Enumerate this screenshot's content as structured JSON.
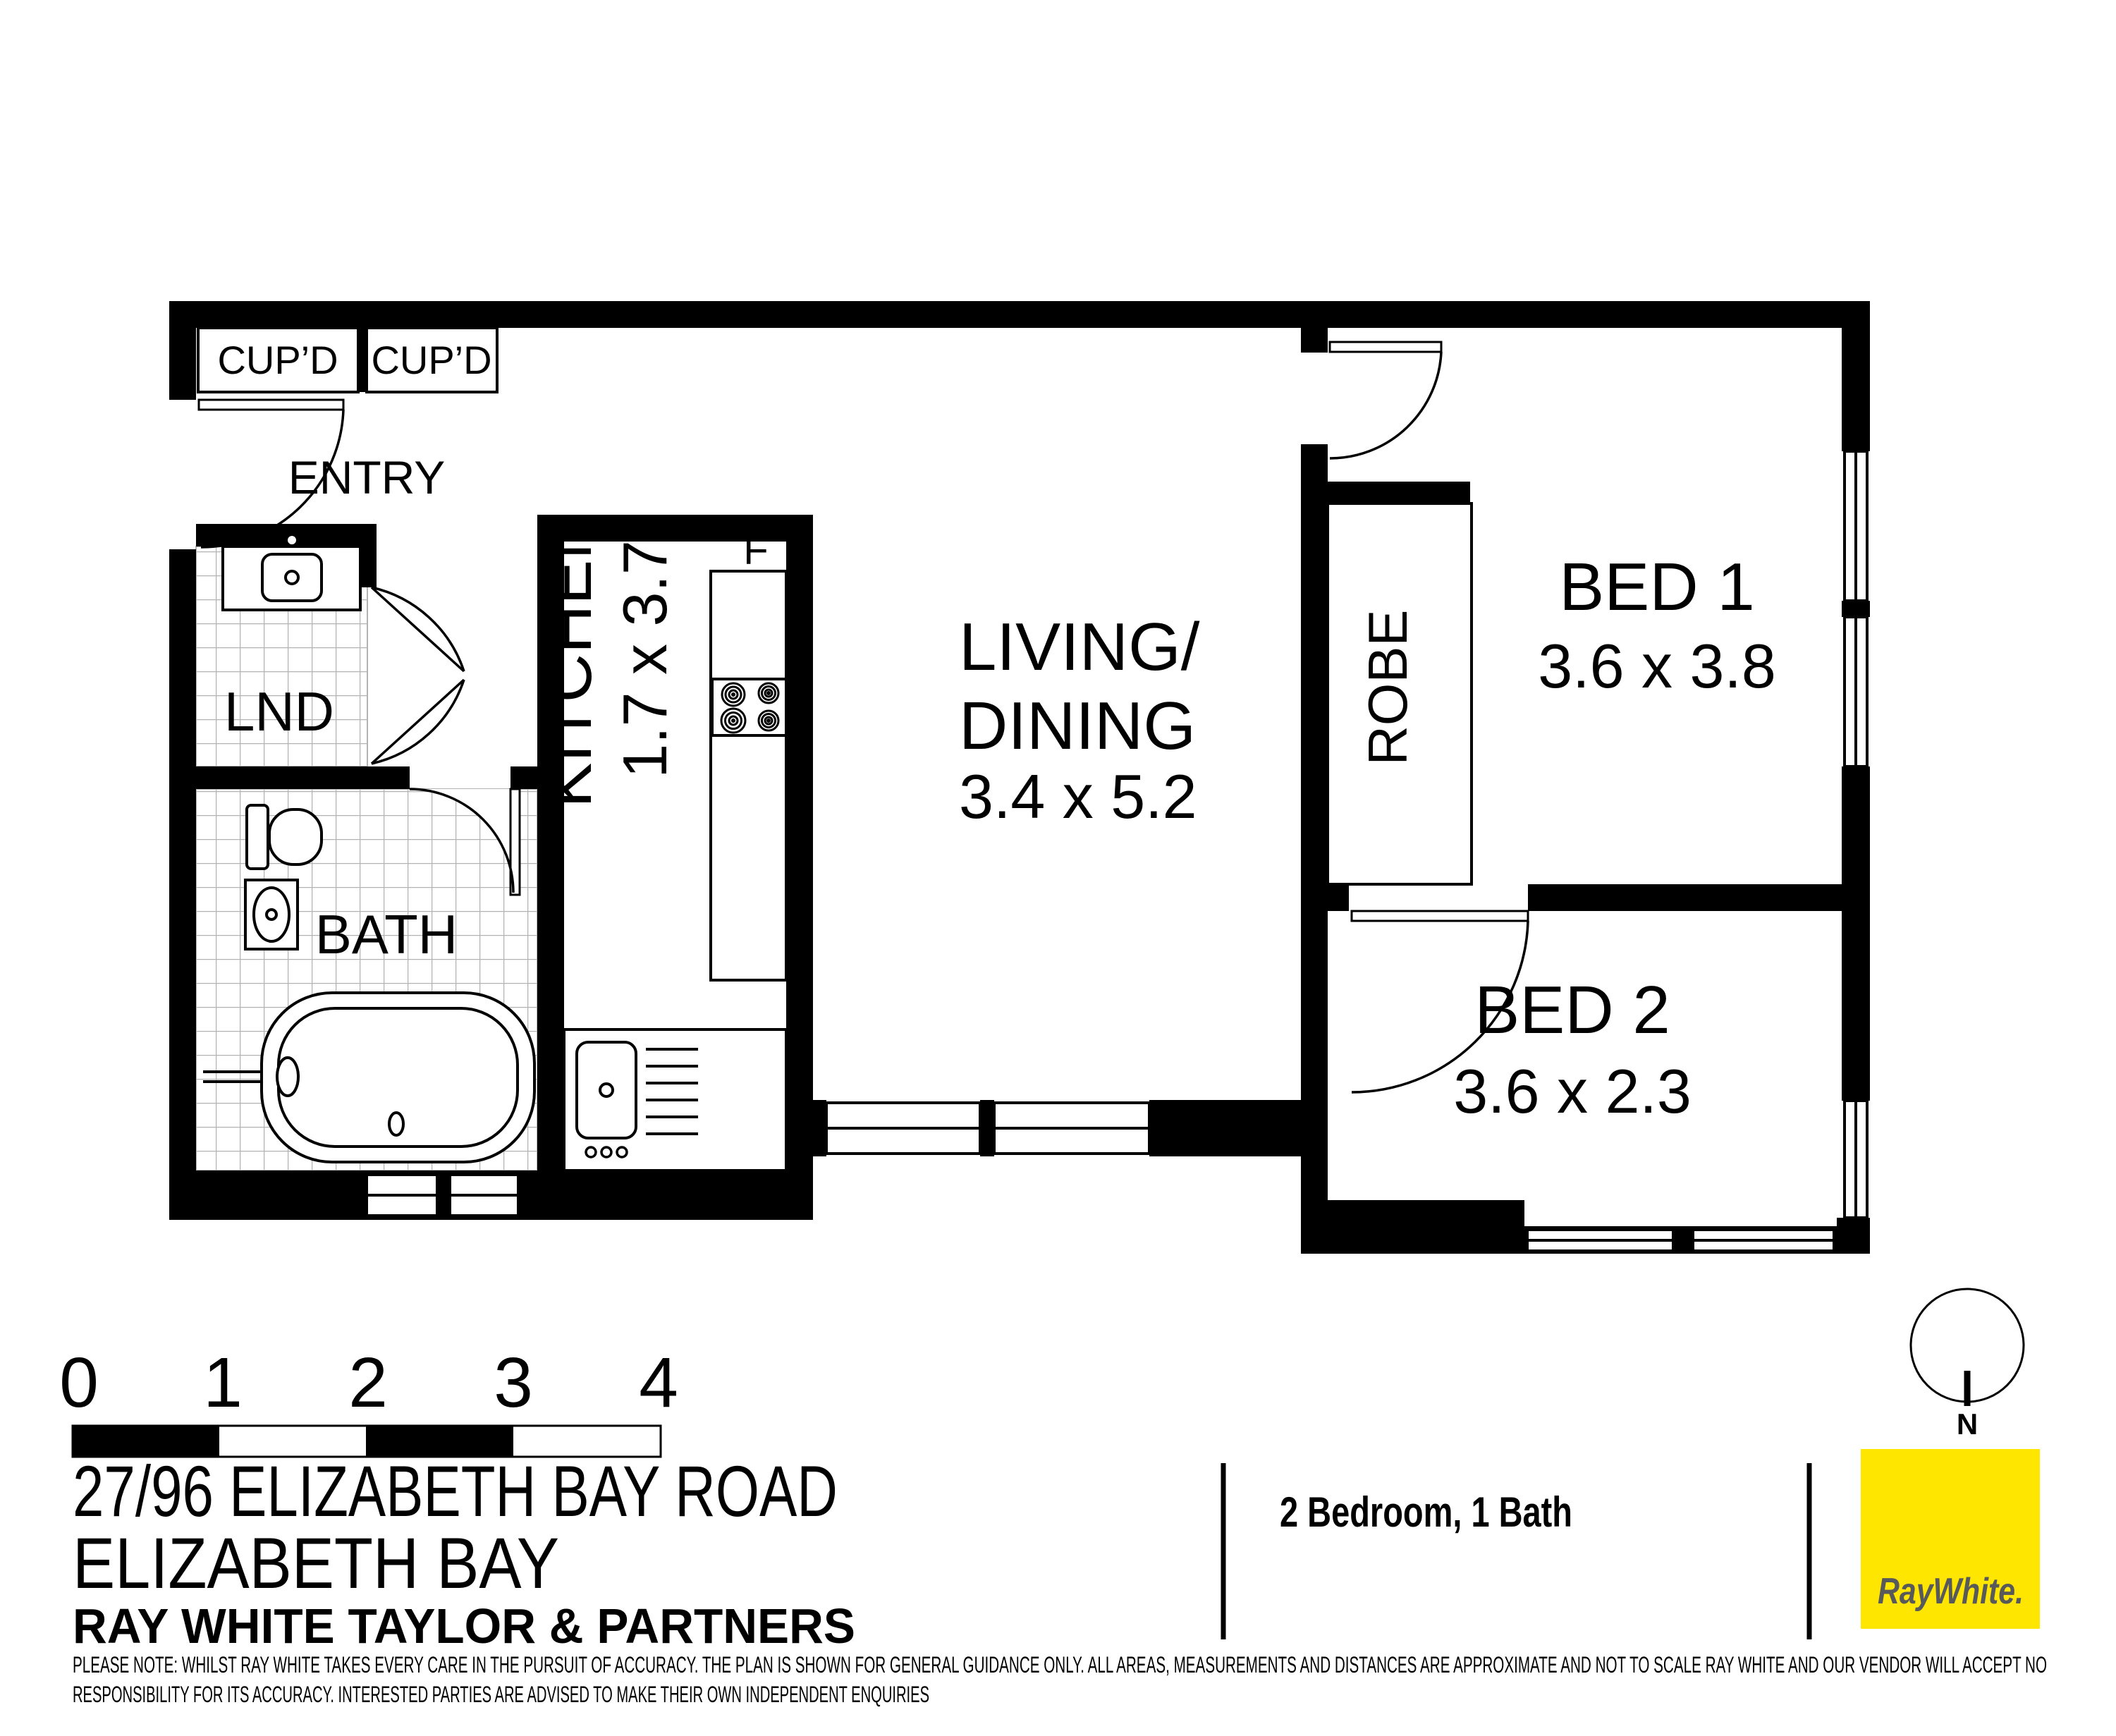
{
  "plan": {
    "rooms": {
      "entry": {
        "label": "ENTRY"
      },
      "cupboard1": {
        "label": "CUP’D"
      },
      "cupboard2": {
        "label": "CUP’D"
      },
      "laundry": {
        "label": "LND"
      },
      "bath": {
        "label": "BATH"
      },
      "kitchen": {
        "label": "KITCHEN",
        "dims": "1.7 x 3.7"
      },
      "living": {
        "label_line1": "LIVING/",
        "label_line2": "DINING",
        "dims": "3.4 x 5.2"
      },
      "robe": {
        "label": "ROBE"
      },
      "fridge": {
        "label": "F"
      },
      "bed1": {
        "label": "BED 1",
        "dims": "3.6 x 3.8"
      },
      "bed2": {
        "label": "BED 2",
        "dims": "3.6 x 2.3"
      }
    },
    "compass": {
      "label": "N"
    },
    "scale_bar": {
      "ticks": [
        "0",
        "1",
        "2",
        "3",
        "4"
      ]
    }
  },
  "footer": {
    "address_line1": "27/96 ELIZABETH BAY ROAD",
    "address_line2": "ELIZABETH BAY",
    "agency": "RAY WHITE TAYLOR & PARTNERS",
    "summary": "2 Bedroom, 1 Bath",
    "disclaimer_line1": "PLEASE NOTE: WHILST RAY WHITE TAKES EVERY CARE IN THE PURSUIT OF ACCURACY. THE PLAN IS SHOWN FOR GENERAL GUIDANCE ONLY. ALL AREAS, MEASUREMENTS AND DISTANCES ARE APPROXIMATE AND NOT TO SCALE RAY WHITE AND OUR VENDOR WILL ACCEPT NO",
    "disclaimer_line2": "RESPONSIBILITY FOR ITS ACCURACY. INTERESTED PARTIES ARE ADVISED TO MAKE THEIR OWN INDEPENDENT ENQUIRIES"
  },
  "branding": {
    "logo_text": "RayWhite.",
    "logo_bg": "#FFE600",
    "logo_fg": "#58595B"
  }
}
